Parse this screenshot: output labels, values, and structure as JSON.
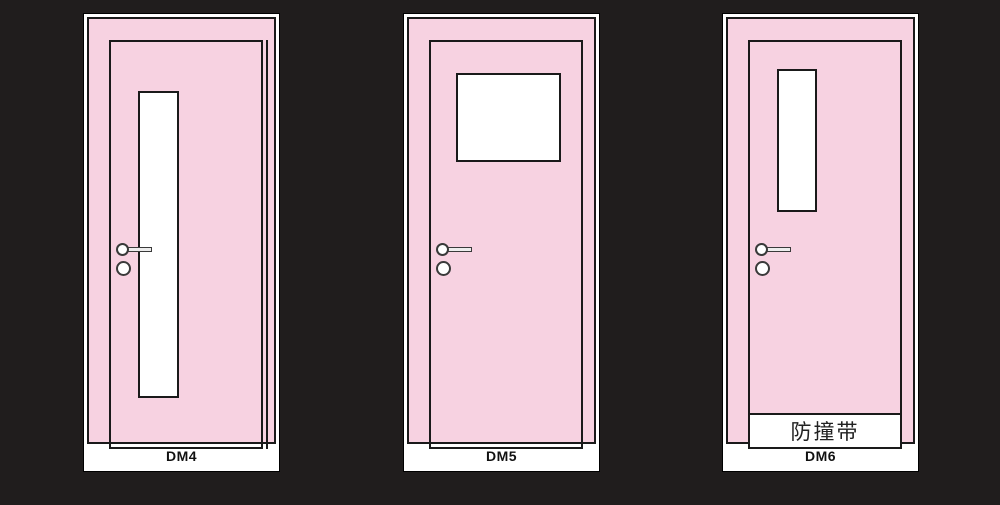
{
  "colors": {
    "bg": "#201D1D",
    "pink": "#F7D2E1",
    "line": "#1A1A1A"
  },
  "doors": [
    {
      "label": "DM4",
      "window_style": "tall-narrow-left"
    },
    {
      "label": "DM5",
      "window_style": "square-top"
    },
    {
      "label": "DM6",
      "window_style": "short-narrow-top-left",
      "bumper_text": "防撞带"
    }
  ]
}
